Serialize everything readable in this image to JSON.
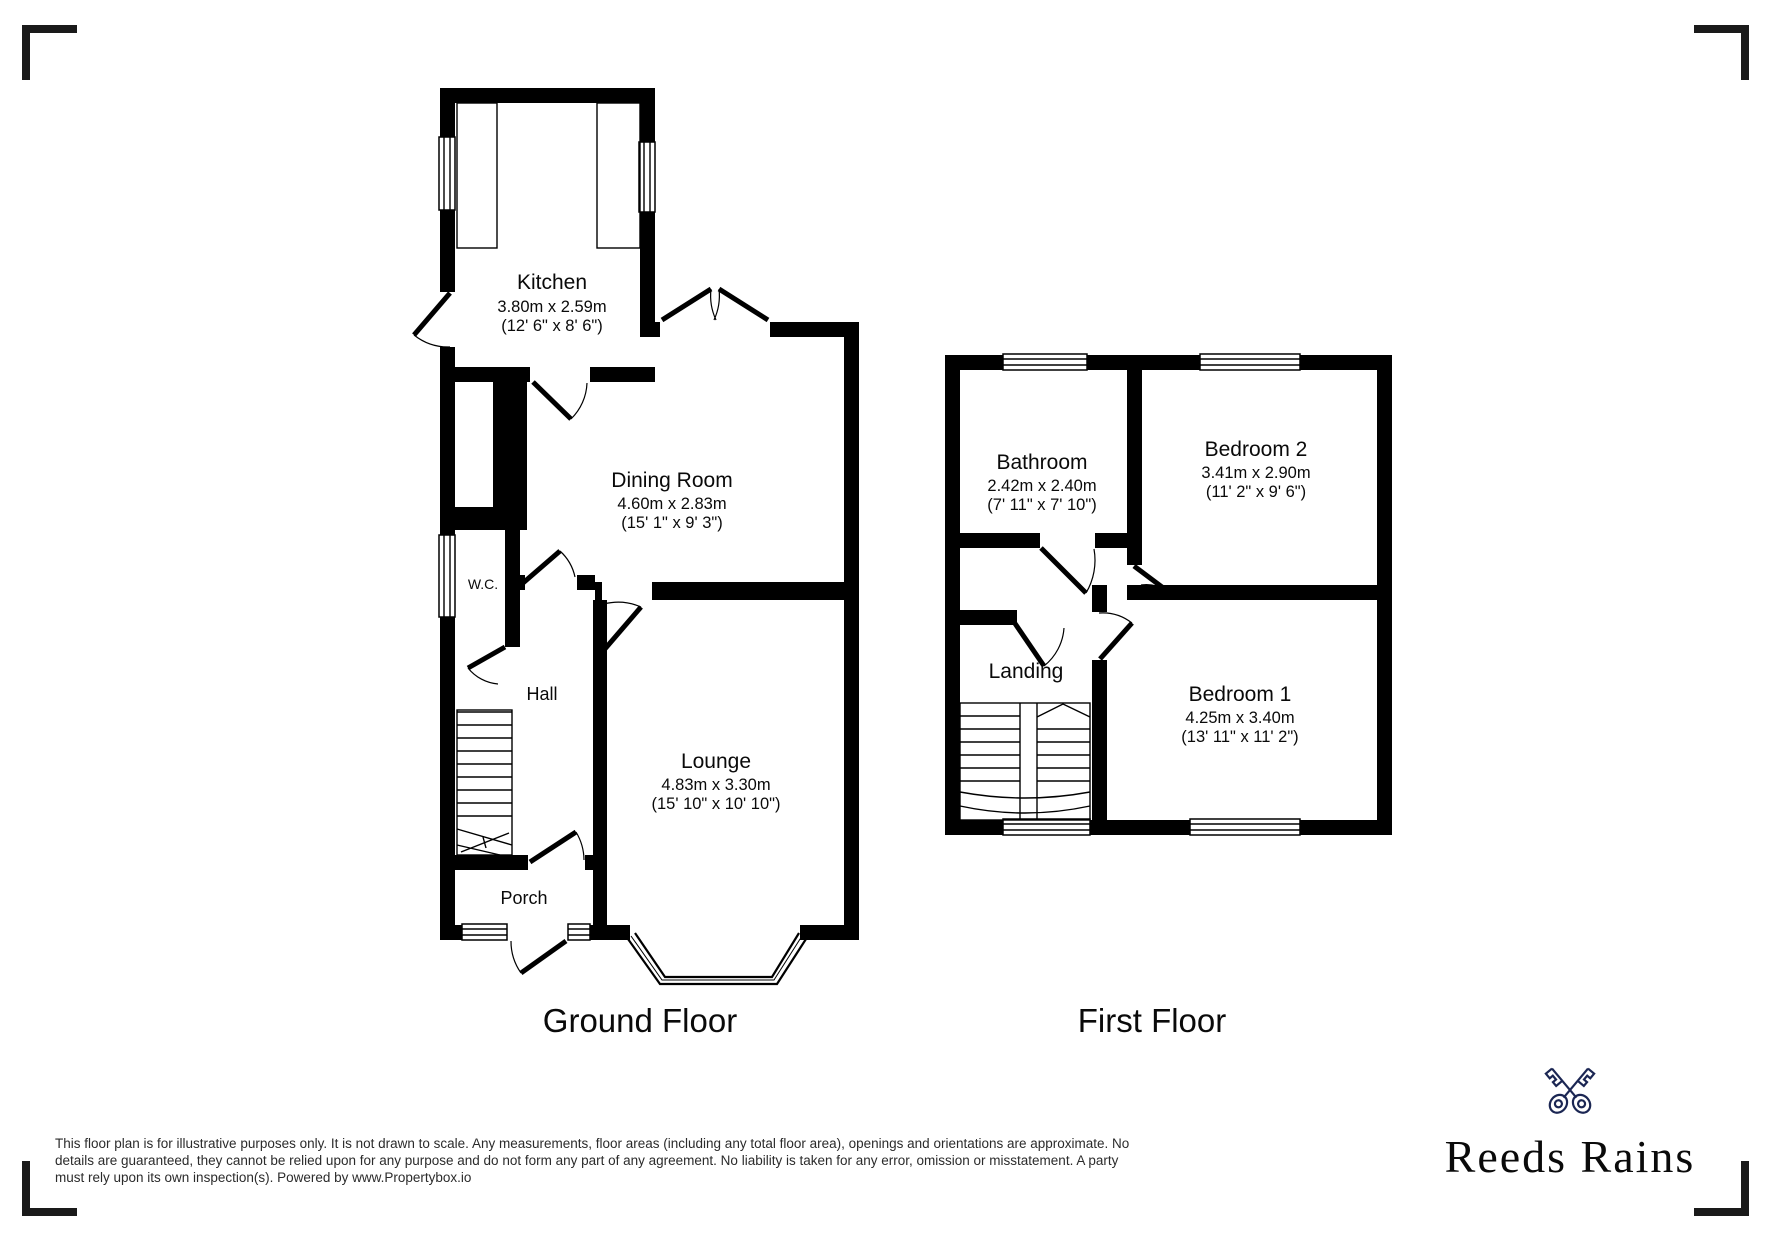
{
  "ground_floor": {
    "title": "Ground Floor",
    "rooms": {
      "kitchen": {
        "name": "Kitchen",
        "metric": "3.80m x 2.59m",
        "imperial": "(12' 6\" x 8' 6\")"
      },
      "dining_room": {
        "name": "Dining Room",
        "metric": "4.60m x 2.83m",
        "imperial": "(15' 1\" x 9' 3\")"
      },
      "wc": {
        "name": "W.C."
      },
      "hall": {
        "name": "Hall"
      },
      "lounge": {
        "name": "Lounge",
        "metric": "4.83m x 3.30m",
        "imperial": "(15' 10\" x 10' 10\")"
      },
      "porch": {
        "name": "Porch"
      }
    }
  },
  "first_floor": {
    "title": "First Floor",
    "rooms": {
      "bathroom": {
        "name": "Bathroom",
        "metric": "2.42m x 2.40m",
        "imperial": "(7' 11\" x 7' 10\")"
      },
      "bedroom_2": {
        "name": "Bedroom 2",
        "metric": "3.41m x 2.90m",
        "imperial": "(11' 2\" x 9' 6\")"
      },
      "landing": {
        "name": "Landing"
      },
      "bedroom_1": {
        "name": "Bedroom 1",
        "metric": "4.25m x 3.40m",
        "imperial": "(13' 11\" x 11' 2\")"
      }
    }
  },
  "footer": {
    "disclaimer_lines": [
      "This floor plan is for illustrative purposes only. It is not drawn to scale. Any measurements, floor areas (including any total floor area), openings and orientations are approximate. No",
      "details are guaranteed, they cannot be relied upon for any purpose and do not form any part of any agreement. No liability is taken for any error, omission or misstatement. A party",
      "must rely upon its own inspection(s). Powered by www.Propertybox.io"
    ],
    "logo": {
      "brand": "Reeds Rains",
      "navy": "#1b2653"
    }
  },
  "colors": {
    "wall": "#000000",
    "background": "#ffffff"
  }
}
